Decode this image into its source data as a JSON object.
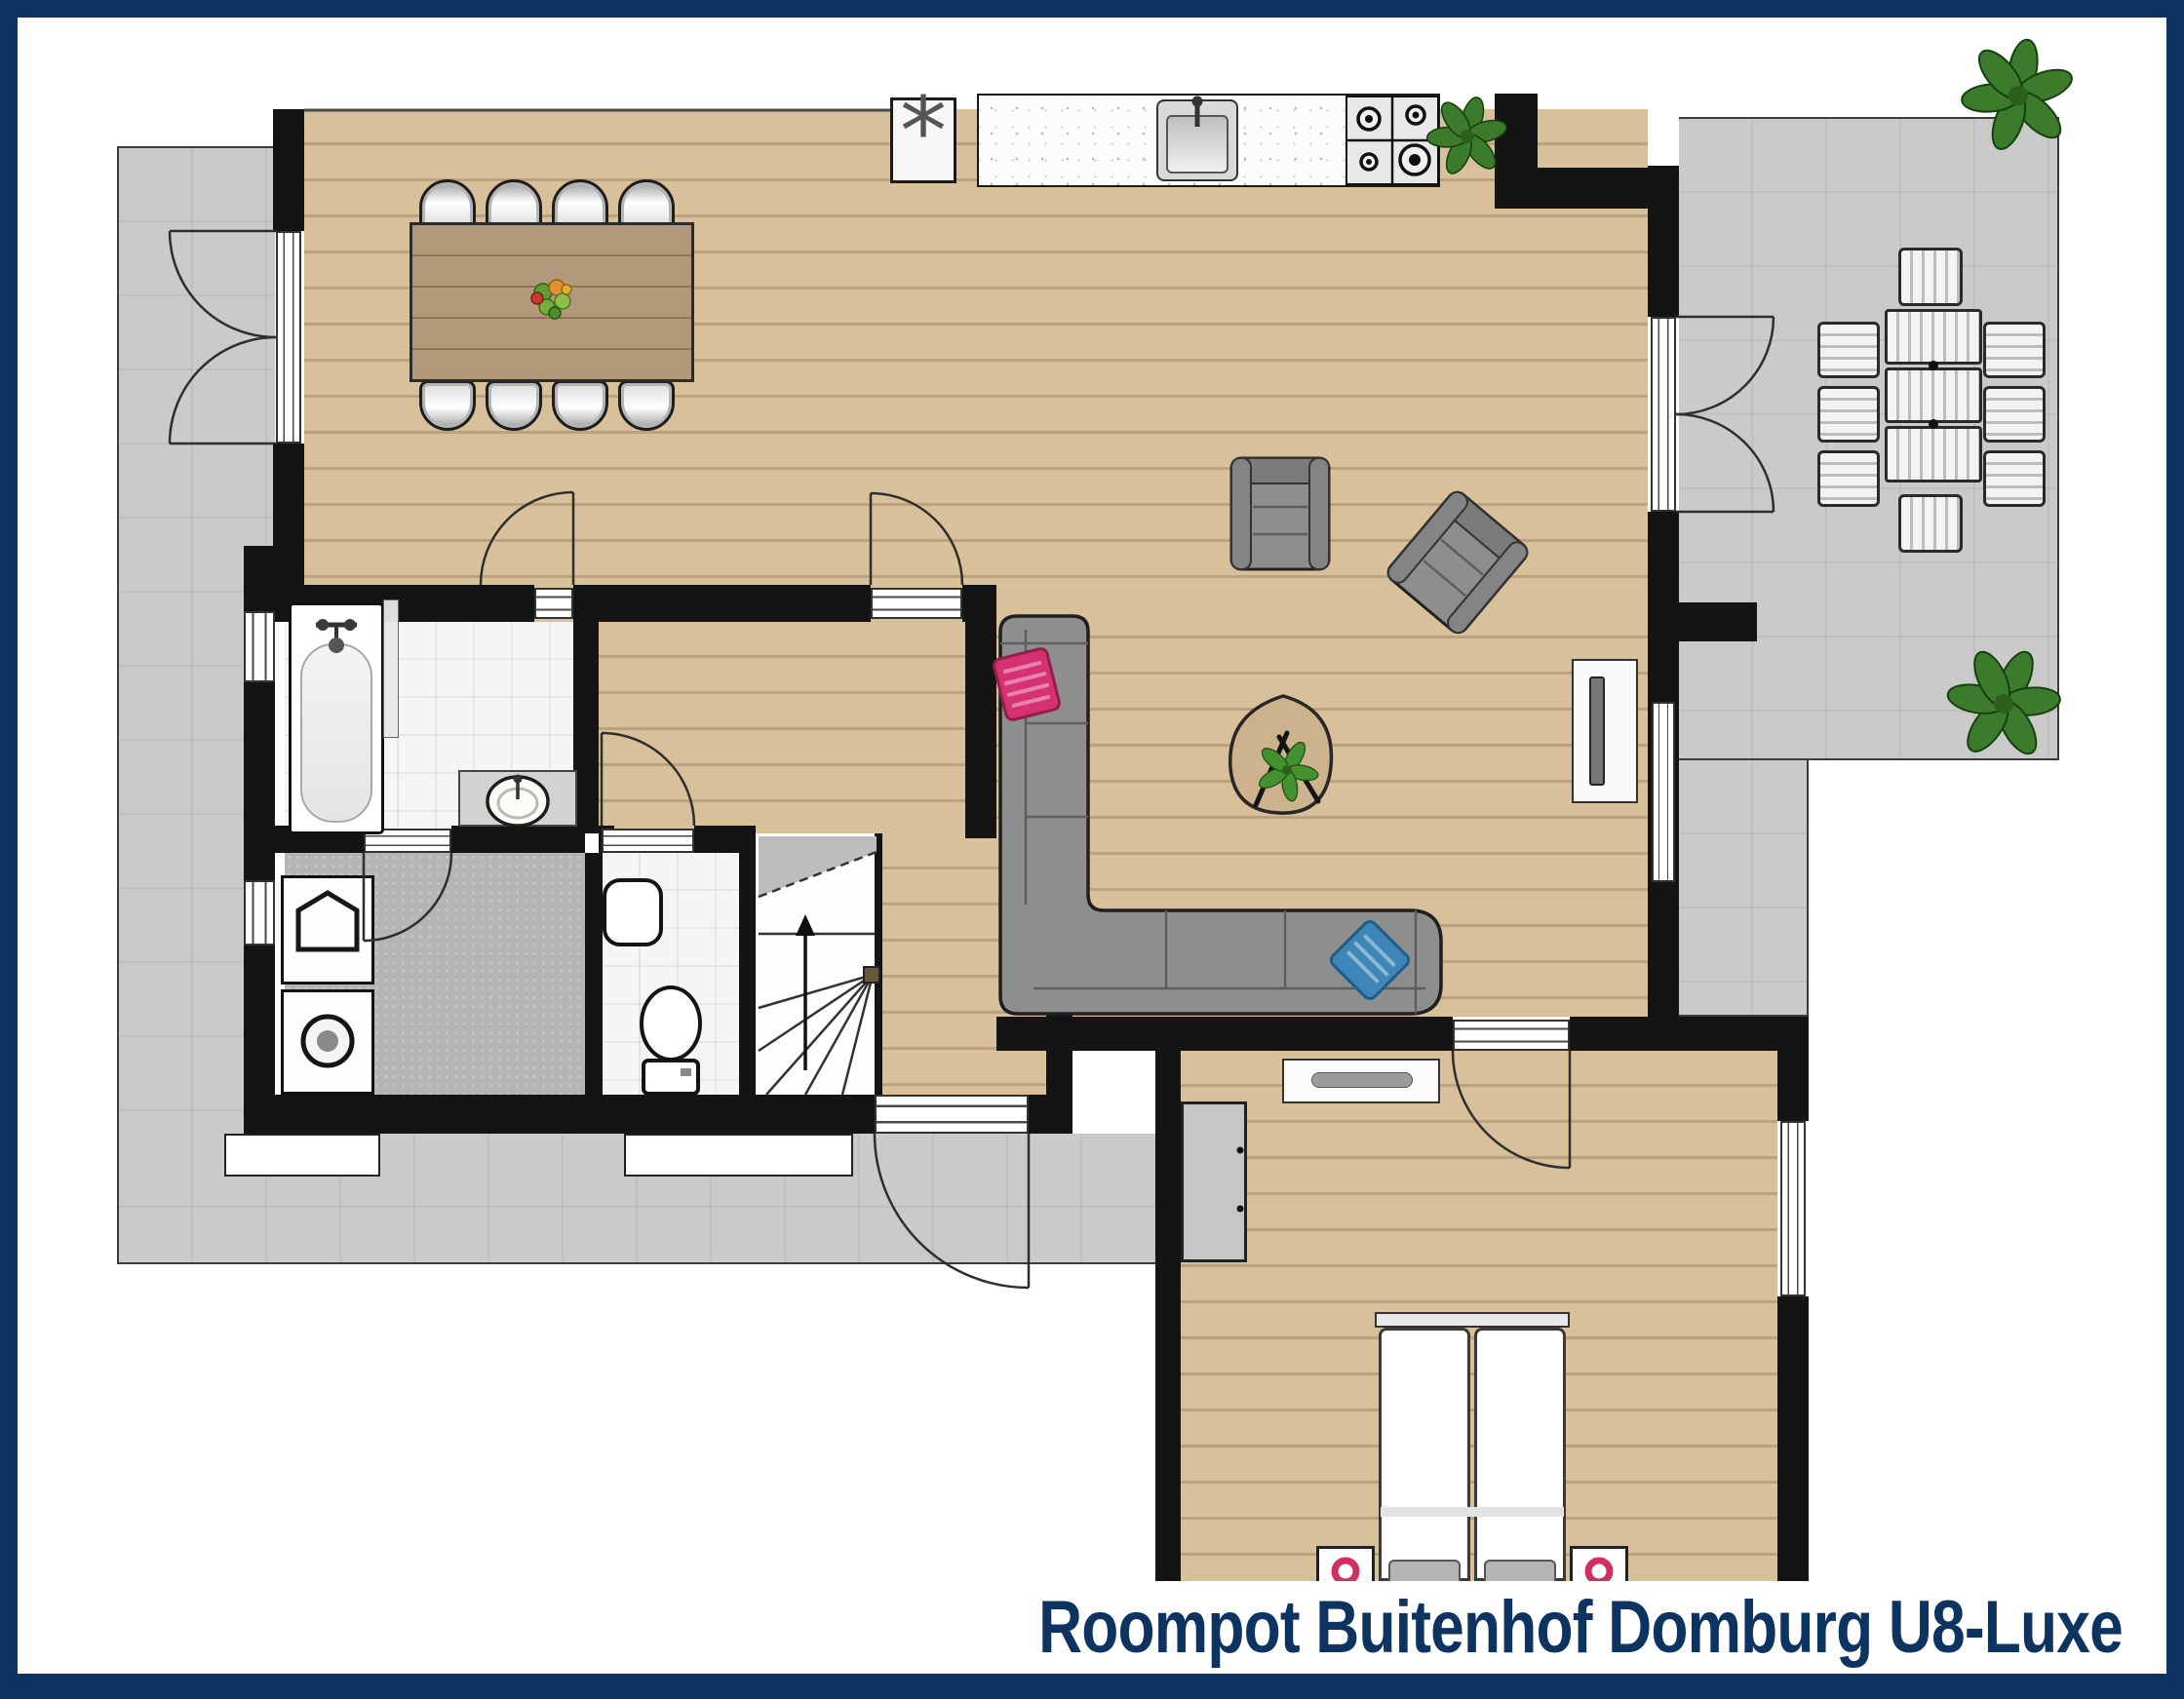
{
  "title": "Roompot Buitenhof Domburg U8-Luxe",
  "colors": {
    "navy": "#0d3460",
    "terrace_gray": "#cacaca",
    "wood_floor": "#d8c09b",
    "wall_black": "#141414",
    "sofa_gray": "#8e8e8e",
    "pillow_pink": "#d63170",
    "pillow_blue": "#3e86b8",
    "plant_green": "#3c7b2b",
    "dining_table_wood": "#b3997c"
  },
  "furniture_icons": [
    "dining-table-icon",
    "dining-chair-icon",
    "fruit-bowl-icon",
    "freezer-icon",
    "kitchen-counter-icon",
    "kitchen-sink-icon",
    "gas-stove-icon",
    "sofa-icon",
    "armchair-icon",
    "coffee-table-icon",
    "tv-cabinet-icon",
    "bathtub-icon",
    "shower-screen-icon",
    "washbasin-icon",
    "toilet-icon",
    "boiler-icon",
    "washing-machine-icon",
    "staircase-icon",
    "stair-direction-arrow-icon",
    "double-bed-icon",
    "nightstand-icon",
    "wardrobe-icon",
    "sideboard-icon",
    "outdoor-table-icon",
    "outdoor-chair-icon",
    "plant-icon",
    "door-swing-icon",
    "window-icon"
  ]
}
